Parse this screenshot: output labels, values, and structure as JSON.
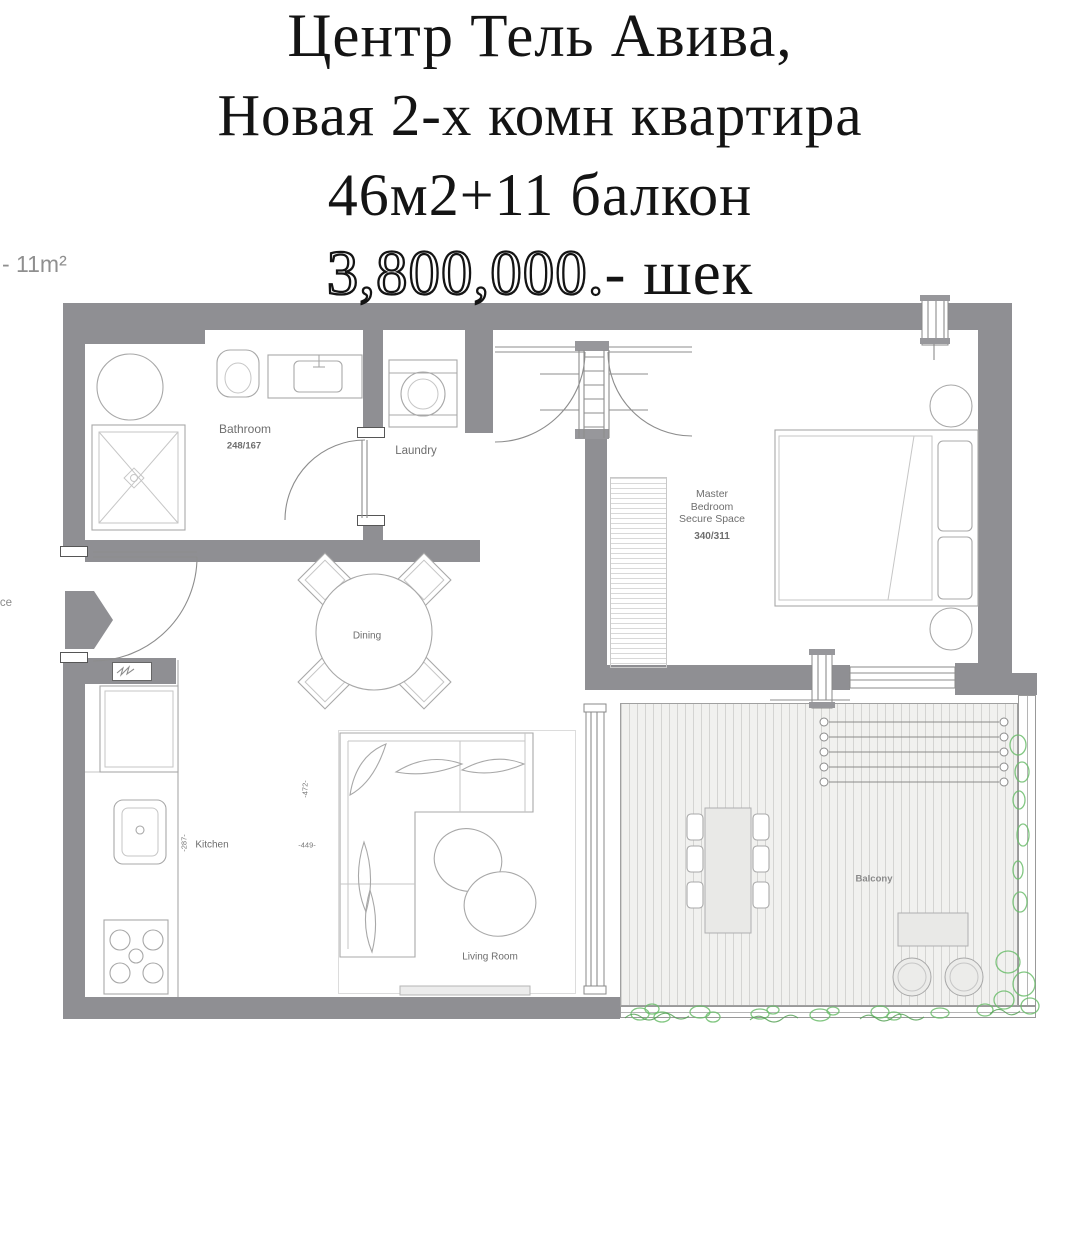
{
  "title": {
    "line1": "Центр Тель Авива,",
    "line2": "Новая 2-х комн квартира",
    "line3": "46м2+11 балкон",
    "price_outline": "3,800,000.",
    "price_suffix": "- шек"
  },
  "notes": {
    "balcony_area": "- 11m²",
    "entrance": "Entrance"
  },
  "rooms": {
    "bathroom": {
      "label": "Bathroom",
      "dims": "248/167"
    },
    "laundry": {
      "label": "Laundry"
    },
    "master_bedroom": {
      "line1": "Master",
      "line2": "Bedroom",
      "line3": "Secure Space",
      "dims": "340/311"
    },
    "dining": {
      "label": "Dining"
    },
    "kitchen": {
      "label": "Kitchen"
    },
    "living_room": {
      "label": "Living Room"
    },
    "balcony": {
      "label": "Balcony"
    }
  },
  "dimensions": {
    "kitchen_depth": "-287-",
    "living_width": "-472-",
    "living_depth": "-449-"
  },
  "colors": {
    "wall": "#8f8f93",
    "plan_line": "#a8a8a8",
    "label_text": "#6e6e6e",
    "plant_green": "#6cbd6c",
    "title_text": "#141414"
  }
}
